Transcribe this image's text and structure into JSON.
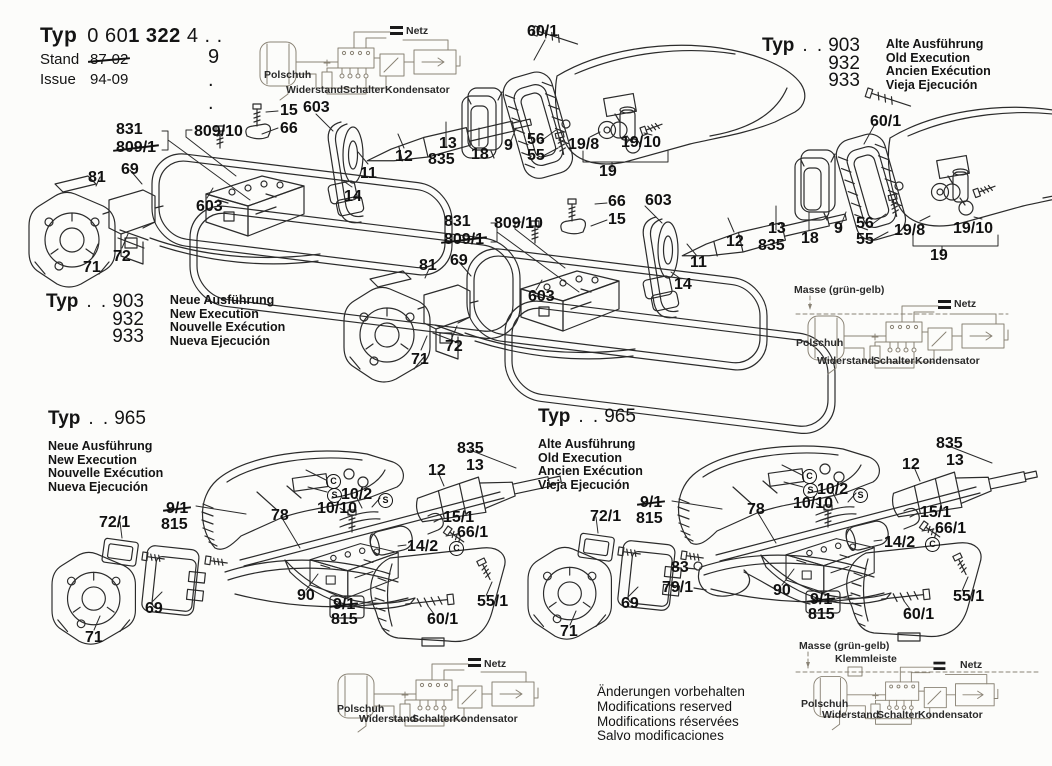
{
  "header": {
    "typ_label": "Typ",
    "typ_num_light": "0 60",
    "typ_num_bold": "1 322",
    "typ_suffix": " 4 . .",
    "typ_line2": "9 . .",
    "stand_label": "Stand",
    "stand_value": "87-02",
    "issue_label": "Issue",
    "issue_value": "94-09"
  },
  "type_blocks": [
    {
      "typ": "Typ",
      "dots": ". .",
      "codes": [
        "903",
        "932",
        "933"
      ],
      "langs": [
        "Alte Ausführung",
        "Old Execution",
        "Ancien Exécution",
        "Vieja Ejecución"
      ]
    },
    {
      "typ": "Typ",
      "dots": ". .",
      "codes": [
        "903",
        "932",
        "933"
      ],
      "langs": [
        "Neue Ausführung",
        "New Execution",
        "Nouvelle Exécution",
        "Nueva Ejecución"
      ]
    },
    {
      "typ": "Typ",
      "dots": ". .",
      "code": "965",
      "langs": [
        "Neue Ausführung",
        "New Execution",
        "Nouvelle Exécution",
        "Nueva Ejecución"
      ]
    },
    {
      "typ": "Typ",
      "dots": ". .",
      "code": "965",
      "langs": [
        "Alte Ausführung",
        "Old Execution",
        "Ancien Exécution",
        "Vieja Ejecución"
      ]
    }
  ],
  "wiring": {
    "netz": "Netz",
    "polschuh": "Polschuh",
    "widerstand": "Widerstand",
    "schalter": "Schalter",
    "kondensator": "Kondensator",
    "masse": "Masse (grün-gelb)",
    "klemmleiste": "Klemmleiste"
  },
  "footer_notes": [
    "Änderungen vorbehalten",
    "Modifications reserved",
    "Modifications réservées",
    "Salvo modificaciones"
  ],
  "callouts": [
    {
      "t": "60/1",
      "x": 527,
      "y": 24
    },
    {
      "t": "15",
      "x": 280,
      "y": 103
    },
    {
      "t": "66",
      "x": 280,
      "y": 121
    },
    {
      "t": "603",
      "x": 303,
      "y": 100
    },
    {
      "t": "831",
      "x": 116,
      "y": 122
    },
    {
      "t": "809/10",
      "x": 194,
      "y": 124
    },
    {
      "t": "809/1",
      "x": 116,
      "y": 140,
      "s": true
    },
    {
      "t": "81",
      "x": 88,
      "y": 170
    },
    {
      "t": "69",
      "x": 121,
      "y": 162
    },
    {
      "t": "12",
      "x": 395,
      "y": 149
    },
    {
      "t": "13",
      "x": 439,
      "y": 136
    },
    {
      "t": "835",
      "x": 428,
      "y": 152
    },
    {
      "t": "18",
      "x": 471,
      "y": 147
    },
    {
      "t": "9",
      "x": 504,
      "y": 138
    },
    {
      "t": "56",
      "x": 527,
      "y": 132
    },
    {
      "t": "55",
      "x": 527,
      "y": 148
    },
    {
      "t": "19/8",
      "x": 568,
      "y": 137
    },
    {
      "t": "19/10",
      "x": 621,
      "y": 135
    },
    {
      "t": "19",
      "x": 599,
      "y": 164
    },
    {
      "t": "603",
      "x": 196,
      "y": 199
    },
    {
      "t": "11",
      "x": 360,
      "y": 166
    },
    {
      "t": "14",
      "x": 344,
      "y": 189
    },
    {
      "t": "72",
      "x": 113,
      "y": 249
    },
    {
      "t": "71",
      "x": 83,
      "y": 260
    },
    {
      "t": "831",
      "x": 444,
      "y": 214
    },
    {
      "t": "809/10",
      "x": 494,
      "y": 216
    },
    {
      "t": "809/1",
      "x": 444,
      "y": 232,
      "s": true
    },
    {
      "t": "66",
      "x": 608,
      "y": 194
    },
    {
      "t": "15",
      "x": 608,
      "y": 212
    },
    {
      "t": "603",
      "x": 645,
      "y": 193
    },
    {
      "t": "81",
      "x": 419,
      "y": 258
    },
    {
      "t": "69",
      "x": 450,
      "y": 253
    },
    {
      "t": "12",
      "x": 726,
      "y": 234
    },
    {
      "t": "13",
      "x": 768,
      "y": 221
    },
    {
      "t": "835",
      "x": 758,
      "y": 238
    },
    {
      "t": "18",
      "x": 801,
      "y": 231
    },
    {
      "t": "9",
      "x": 834,
      "y": 221
    },
    {
      "t": "56",
      "x": 856,
      "y": 216
    },
    {
      "t": "55",
      "x": 856,
      "y": 232
    },
    {
      "t": "19/8",
      "x": 894,
      "y": 223
    },
    {
      "t": "19/10",
      "x": 953,
      "y": 221
    },
    {
      "t": "19",
      "x": 930,
      "y": 248
    },
    {
      "t": "60/1",
      "x": 870,
      "y": 114
    },
    {
      "t": "603",
      "x": 528,
      "y": 289
    },
    {
      "t": "11",
      "x": 690,
      "y": 255
    },
    {
      "t": "14",
      "x": 674,
      "y": 277
    },
    {
      "t": "72",
      "x": 445,
      "y": 339
    },
    {
      "t": "71",
      "x": 411,
      "y": 352
    },
    {
      "t": "835",
      "x": 457,
      "y": 441
    },
    {
      "t": "13",
      "x": 466,
      "y": 458
    },
    {
      "t": "12",
      "x": 428,
      "y": 463
    },
    {
      "t": "10/2",
      "x": 341,
      "y": 487
    },
    {
      "t": "S",
      "circ": true,
      "x": 378,
      "y": 493
    },
    {
      "t": "10/10",
      "x": 317,
      "y": 501
    },
    {
      "t": "C",
      "circ": true,
      "x": 326,
      "y": 474
    },
    {
      "t": "S",
      "circ": true,
      "x": 327,
      "y": 488
    },
    {
      "t": "9/1",
      "x": 166,
      "y": 501,
      "s": true
    },
    {
      "t": "815",
      "x": 161,
      "y": 517
    },
    {
      "t": "78",
      "x": 271,
      "y": 508
    },
    {
      "t": "72/1",
      "x": 99,
      "y": 515
    },
    {
      "t": "15/1",
      "x": 443,
      "y": 510
    },
    {
      "t": "66/1",
      "x": 457,
      "y": 525
    },
    {
      "t": "14/2",
      "x": 407,
      "y": 539
    },
    {
      "t": "C",
      "circ": true,
      "x": 449,
      "y": 541
    },
    {
      "t": "69",
      "x": 145,
      "y": 601
    },
    {
      "t": "71",
      "x": 85,
      "y": 630
    },
    {
      "t": "90",
      "x": 297,
      "y": 588
    },
    {
      "t": "9/1",
      "x": 333,
      "y": 597,
      "s": true
    },
    {
      "t": "815",
      "x": 331,
      "y": 612
    },
    {
      "t": "60/1",
      "x": 427,
      "y": 612
    },
    {
      "t": "55/1",
      "x": 477,
      "y": 594
    },
    {
      "t": "835",
      "x": 936,
      "y": 436
    },
    {
      "t": "13",
      "x": 946,
      "y": 453
    },
    {
      "t": "12",
      "x": 902,
      "y": 457
    },
    {
      "t": "10/2",
      "x": 817,
      "y": 482
    },
    {
      "t": "S",
      "circ": true,
      "x": 853,
      "y": 488
    },
    {
      "t": "10/10",
      "x": 793,
      "y": 496
    },
    {
      "t": "C",
      "circ": true,
      "x": 802,
      "y": 469
    },
    {
      "t": "S",
      "circ": true,
      "x": 803,
      "y": 483
    },
    {
      "t": "9/1",
      "x": 640,
      "y": 495,
      "s": true
    },
    {
      "t": "815",
      "x": 636,
      "y": 511
    },
    {
      "t": "78",
      "x": 747,
      "y": 502
    },
    {
      "t": "72/1",
      "x": 590,
      "y": 509
    },
    {
      "t": "15/1",
      "x": 920,
      "y": 505
    },
    {
      "t": "66/1",
      "x": 935,
      "y": 521
    },
    {
      "t": "14/2",
      "x": 884,
      "y": 535
    },
    {
      "t": "C",
      "circ": true,
      "x": 925,
      "y": 537
    },
    {
      "t": "83",
      "x": 671,
      "y": 560
    },
    {
      "t": "79/1",
      "x": 662,
      "y": 580
    },
    {
      "t": "69",
      "x": 621,
      "y": 596
    },
    {
      "t": "71",
      "x": 560,
      "y": 624
    },
    {
      "t": "90",
      "x": 773,
      "y": 583
    },
    {
      "t": "9/1",
      "x": 810,
      "y": 592,
      "s": true
    },
    {
      "t": "815",
      "x": 808,
      "y": 607
    },
    {
      "t": "60/1",
      "x": 903,
      "y": 607
    },
    {
      "t": "55/1",
      "x": 953,
      "y": 589
    }
  ]
}
